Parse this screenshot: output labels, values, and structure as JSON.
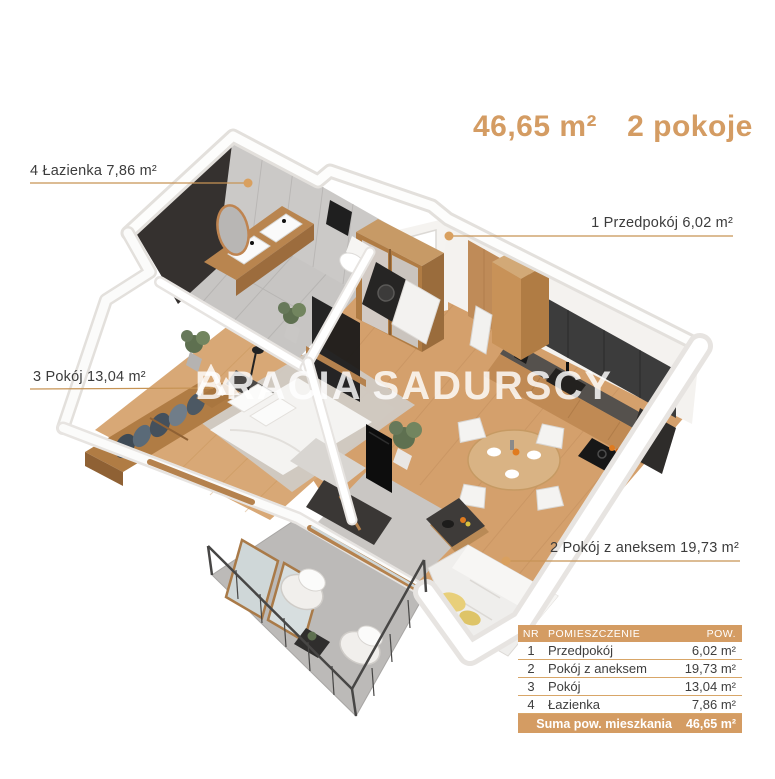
{
  "header": {
    "area": "46,65 m²",
    "rooms": "2 pokoje"
  },
  "labels": {
    "bathroom": "4 Łazienka 7,86 m²",
    "hall": "1 Przedpokój 6,02 m²",
    "room": "3 Pokój 13,04 m²",
    "living": "2 Pokój z aneksem 19,73 m²"
  },
  "watermark": {
    "left": "BRACIA",
    "right": "SADURSCY"
  },
  "table": {
    "headers": {
      "nr": "NR",
      "name": "POMIESZCZENIE",
      "area": "POW."
    },
    "rows": [
      {
        "nr": "1",
        "name": "Przedpokój",
        "area": "6,02 m²"
      },
      {
        "nr": "2",
        "name": "Pokój z aneksem",
        "area": "19,73 m²"
      },
      {
        "nr": "3",
        "name": "Pokój",
        "area": "13,04 m²"
      },
      {
        "nr": "4",
        "name": "Łazienka",
        "area": "7,86 m²"
      }
    ],
    "footer": {
      "label": "Suma pow. mieszkania",
      "value": "46,65 m²"
    }
  },
  "colors": {
    "accent": "#d49c63",
    "leader_line": "#c79455",
    "label_text": "#3c3c3c",
    "wood_floor": "#d4a06c",
    "dark_wall": "#35312f",
    "tile_wall": "#cbc9c7"
  }
}
